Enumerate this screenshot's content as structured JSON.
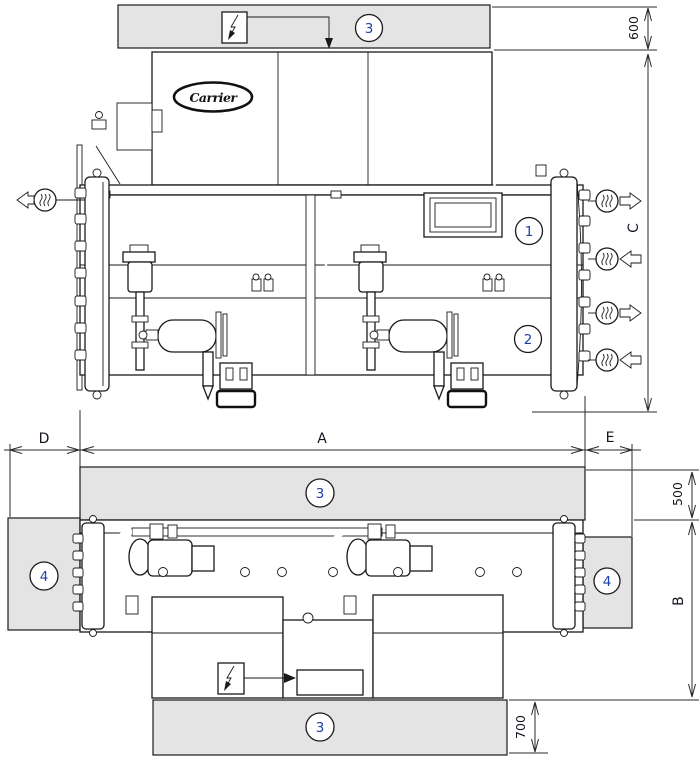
{
  "document": {
    "type": "installation-clearance-diagram",
    "brand_label": "Carrier"
  },
  "callouts": {
    "n1": "1",
    "n2": "2",
    "n3": "3",
    "n4": "4"
  },
  "dims": {
    "top_clearance": "600",
    "unit_height": "C",
    "left_clearance": "D",
    "unit_length": "A",
    "right_clearance": "E",
    "side_clearance": "500",
    "unit_width": "B",
    "front_clearance": "700"
  },
  "colors": {
    "clearance_fill": "#e4e4e4",
    "line": "#1a1a1a",
    "callout_text": "#1e3faa"
  }
}
